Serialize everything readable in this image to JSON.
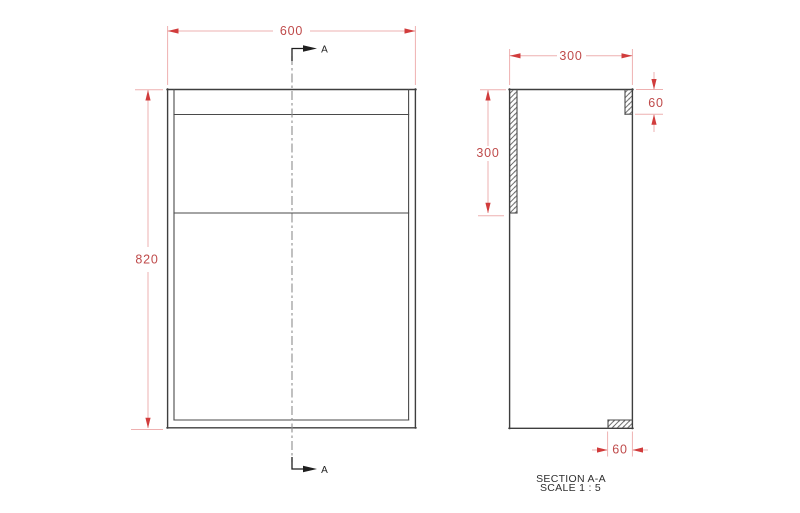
{
  "front_view": {
    "width_dim": "600",
    "height_dim": "820"
  },
  "section_cut": {
    "top_label": "A",
    "bottom_label": "A"
  },
  "section_view": {
    "width_dim": "300",
    "back_panel_dim": "300",
    "top_rail_dim": "60",
    "bottom_rail_dim": "60",
    "caption_title": "SECTION A-A",
    "caption_scale": "SCALE 1 : 5"
  },
  "colors": {
    "dimension_text": "#bf4a4a",
    "dimension_line": "#eeb0b0",
    "dimension_arrow": "#d13c3c",
    "outline": "#3e3e3e",
    "centerline": "#8e8e8e",
    "hatch": "#5a5a5a",
    "background": "#ffffff"
  }
}
